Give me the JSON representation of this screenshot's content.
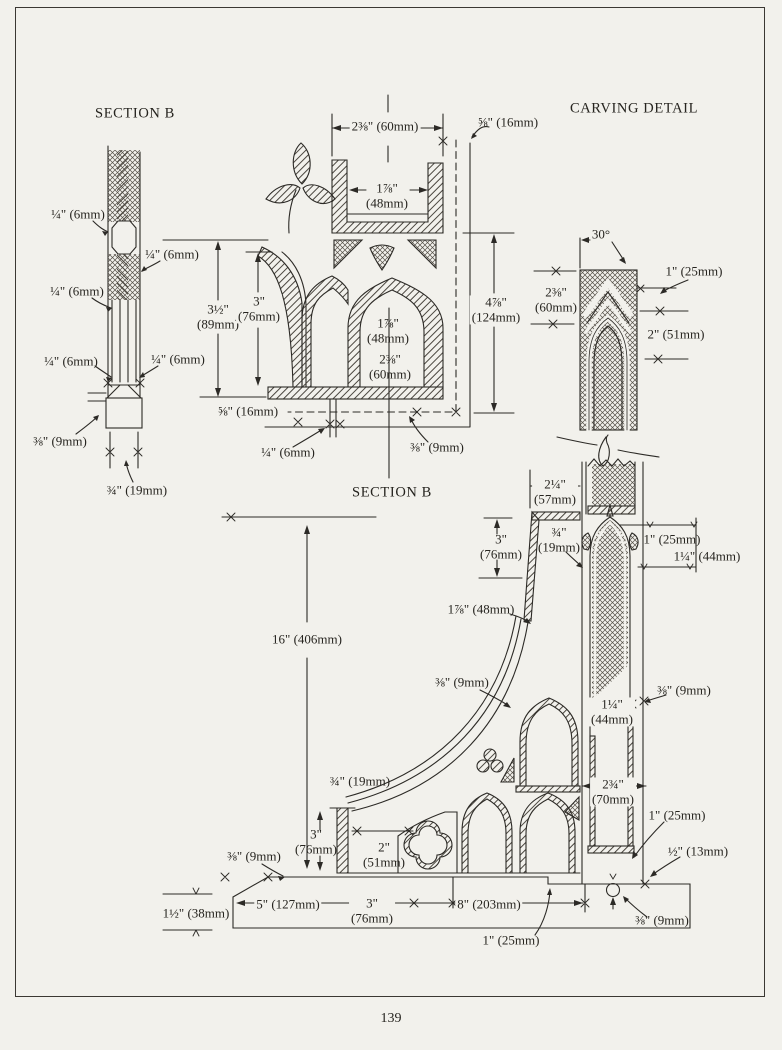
{
  "page": {
    "number": "139",
    "paper_color": "#f2f1ec",
    "ink_color": "#2c2a26"
  },
  "titles": {
    "top_left": "SECTION B",
    "top_right": "CARVING DETAIL",
    "bottom": "SECTION B"
  },
  "annotations": [
    {
      "text": "¼\" (6mm)",
      "x": 78,
      "y": 215,
      "bg": false,
      "group": "left-profile"
    },
    {
      "text": "¼\" (6mm)",
      "x": 172,
      "y": 255,
      "bg": false,
      "group": "left-profile"
    },
    {
      "text": "¼\" (6mm)",
      "x": 77,
      "y": 292,
      "bg": false,
      "group": "left-profile"
    },
    {
      "text": "¼\" (6mm)",
      "x": 71,
      "y": 362,
      "bg": false,
      "group": "left-profile"
    },
    {
      "text": "¼\" (6mm)",
      "x": 178,
      "y": 360,
      "bg": false,
      "group": "left-profile"
    },
    {
      "text": "⅜\" (9mm)",
      "x": 60,
      "y": 442,
      "bg": false,
      "group": "left-profile"
    },
    {
      "text": "¾\" (19mm)",
      "x": 137,
      "y": 491,
      "bg": false,
      "group": "left-profile"
    },
    {
      "text": "2⅜\" (60mm)",
      "x": 385,
      "y": 127,
      "bg": true,
      "group": "tracery-plan"
    },
    {
      "text": "⅝\" (16mm)",
      "x": 508,
      "y": 123,
      "bg": false,
      "group": "tracery-plan"
    },
    {
      "text": "1⅞\"\n(48mm)",
      "x": 387,
      "y": 196,
      "bg": false,
      "group": "tracery-plan"
    },
    {
      "text": "3½\"\n(89mm)",
      "x": 218,
      "y": 317,
      "bg": true,
      "group": "tracery-plan"
    },
    {
      "text": "3\"\n(76mm)",
      "x": 259,
      "y": 309,
      "bg": true,
      "group": "tracery-plan"
    },
    {
      "text": "1⅞\"\n(48mm)",
      "x": 388,
      "y": 331,
      "bg": false,
      "group": "tracery-plan"
    },
    {
      "text": "2⅜\"\n(60mm)",
      "x": 390,
      "y": 367,
      "bg": false,
      "group": "tracery-plan"
    },
    {
      "text": "4⅞\"\n(124mm)",
      "x": 496,
      "y": 310,
      "bg": true,
      "group": "tracery-plan"
    },
    {
      "text": "⅝\" (16mm)",
      "x": 248,
      "y": 412,
      "bg": true,
      "group": "tracery-plan"
    },
    {
      "text": "¼\" (6mm)",
      "x": 288,
      "y": 453,
      "bg": false,
      "group": "tracery-plan"
    },
    {
      "text": "⅜\" (9mm)",
      "x": 437,
      "y": 448,
      "bg": false,
      "group": "tracery-plan"
    },
    {
      "text": "30°",
      "x": 601,
      "y": 235,
      "bg": false,
      "group": "carving-detail"
    },
    {
      "text": "1\" (25mm)",
      "x": 694,
      "y": 272,
      "bg": false,
      "group": "carving-detail"
    },
    {
      "text": "2⅜\"\n(60mm)",
      "x": 556,
      "y": 300,
      "bg": true,
      "group": "carving-detail"
    },
    {
      "text": "2\" (51mm)",
      "x": 676,
      "y": 335,
      "bg": false,
      "group": "carving-detail"
    },
    {
      "text": "2¼\"\n(57mm)",
      "x": 555,
      "y": 492,
      "bg": true,
      "group": "bracket-section"
    },
    {
      "text": "3\"\n(76mm)",
      "x": 501,
      "y": 547,
      "bg": false,
      "group": "bracket-section"
    },
    {
      "text": "¾\"\n(19mm)",
      "x": 559,
      "y": 540,
      "bg": false,
      "group": "bracket-section"
    },
    {
      "text": "1⅞\" (48mm)",
      "x": 481,
      "y": 610,
      "bg": false,
      "group": "bracket-section"
    },
    {
      "text": "1\" (25mm)",
      "x": 672,
      "y": 540,
      "bg": false,
      "group": "bracket-section"
    },
    {
      "text": "1¼\" (44mm)",
      "x": 707,
      "y": 557,
      "bg": false,
      "group": "bracket-section"
    },
    {
      "text": "16\" (406mm)",
      "x": 307,
      "y": 640,
      "bg": true,
      "group": "bracket-section"
    },
    {
      "text": "⅜\" (9mm)",
      "x": 462,
      "y": 683,
      "bg": false,
      "group": "bracket-section"
    },
    {
      "text": "⅜\" (9mm)",
      "x": 684,
      "y": 691,
      "bg": false,
      "group": "bracket-section"
    },
    {
      "text": "1¼\"\n(44mm)",
      "x": 612,
      "y": 712,
      "bg": true,
      "group": "bracket-section"
    },
    {
      "text": "¾\" (19mm)",
      "x": 360,
      "y": 782,
      "bg": false,
      "group": "bracket-section"
    },
    {
      "text": "2¾\"\n(70mm)",
      "x": 613,
      "y": 792,
      "bg": true,
      "group": "bracket-section"
    },
    {
      "text": "3\"\n(76mm)",
      "x": 316,
      "y": 842,
      "bg": false,
      "group": "bracket-section"
    },
    {
      "text": "⅜\" (9mm)",
      "x": 254,
      "y": 857,
      "bg": false,
      "group": "bracket-section"
    },
    {
      "text": "2\"\n(51mm)",
      "x": 384,
      "y": 855,
      "bg": false,
      "group": "bracket-section"
    },
    {
      "text": "1\" (25mm)",
      "x": 677,
      "y": 816,
      "bg": false,
      "group": "bracket-section"
    },
    {
      "text": "½\" (13mm)",
      "x": 698,
      "y": 852,
      "bg": false,
      "group": "bracket-section"
    },
    {
      "text": "5\" (127mm)",
      "x": 288,
      "y": 905,
      "bg": true,
      "group": "bracket-section"
    },
    {
      "text": "1½\" (38mm)",
      "x": 196,
      "y": 914,
      "bg": false,
      "group": "bracket-section"
    },
    {
      "text": "3\"\n(76mm)",
      "x": 372,
      "y": 911,
      "bg": true,
      "group": "bracket-section"
    },
    {
      "text": "8\" (203mm)",
      "x": 489,
      "y": 905,
      "bg": true,
      "group": "bracket-section"
    },
    {
      "text": "⅜\" (9mm)",
      "x": 662,
      "y": 921,
      "bg": false,
      "group": "bracket-section"
    },
    {
      "text": "1\" (25mm)",
      "x": 511,
      "y": 941,
      "bg": false,
      "group": "bracket-section"
    }
  ]
}
